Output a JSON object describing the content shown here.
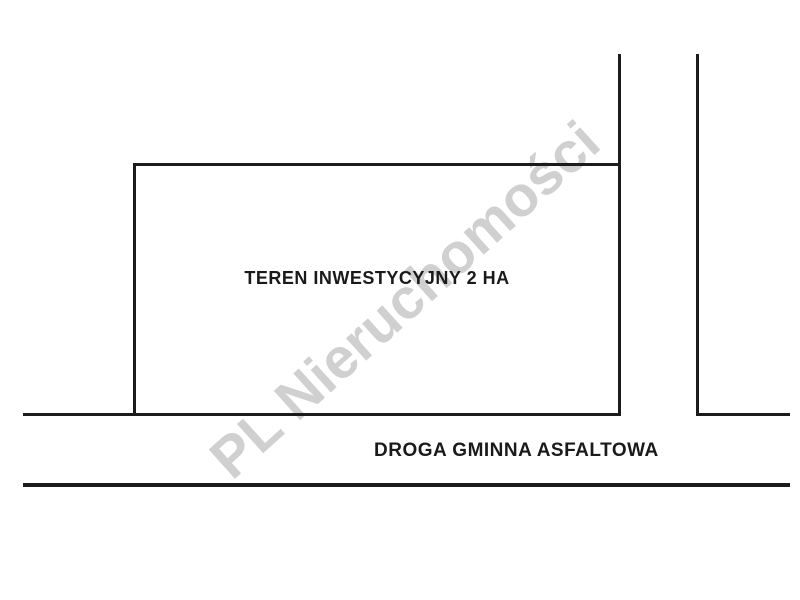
{
  "diagram": {
    "plot_label": "TEREN INWESTYCYJNY 2 HA",
    "road_label": "DROGA GMINNA ASFALTOWA",
    "watermark_text": "PL Nieruchomości",
    "colors": {
      "background": "#ffffff",
      "line": "#1c1c1c",
      "text": "#1a1a1a",
      "watermark": "#d0d0d0"
    }
  }
}
